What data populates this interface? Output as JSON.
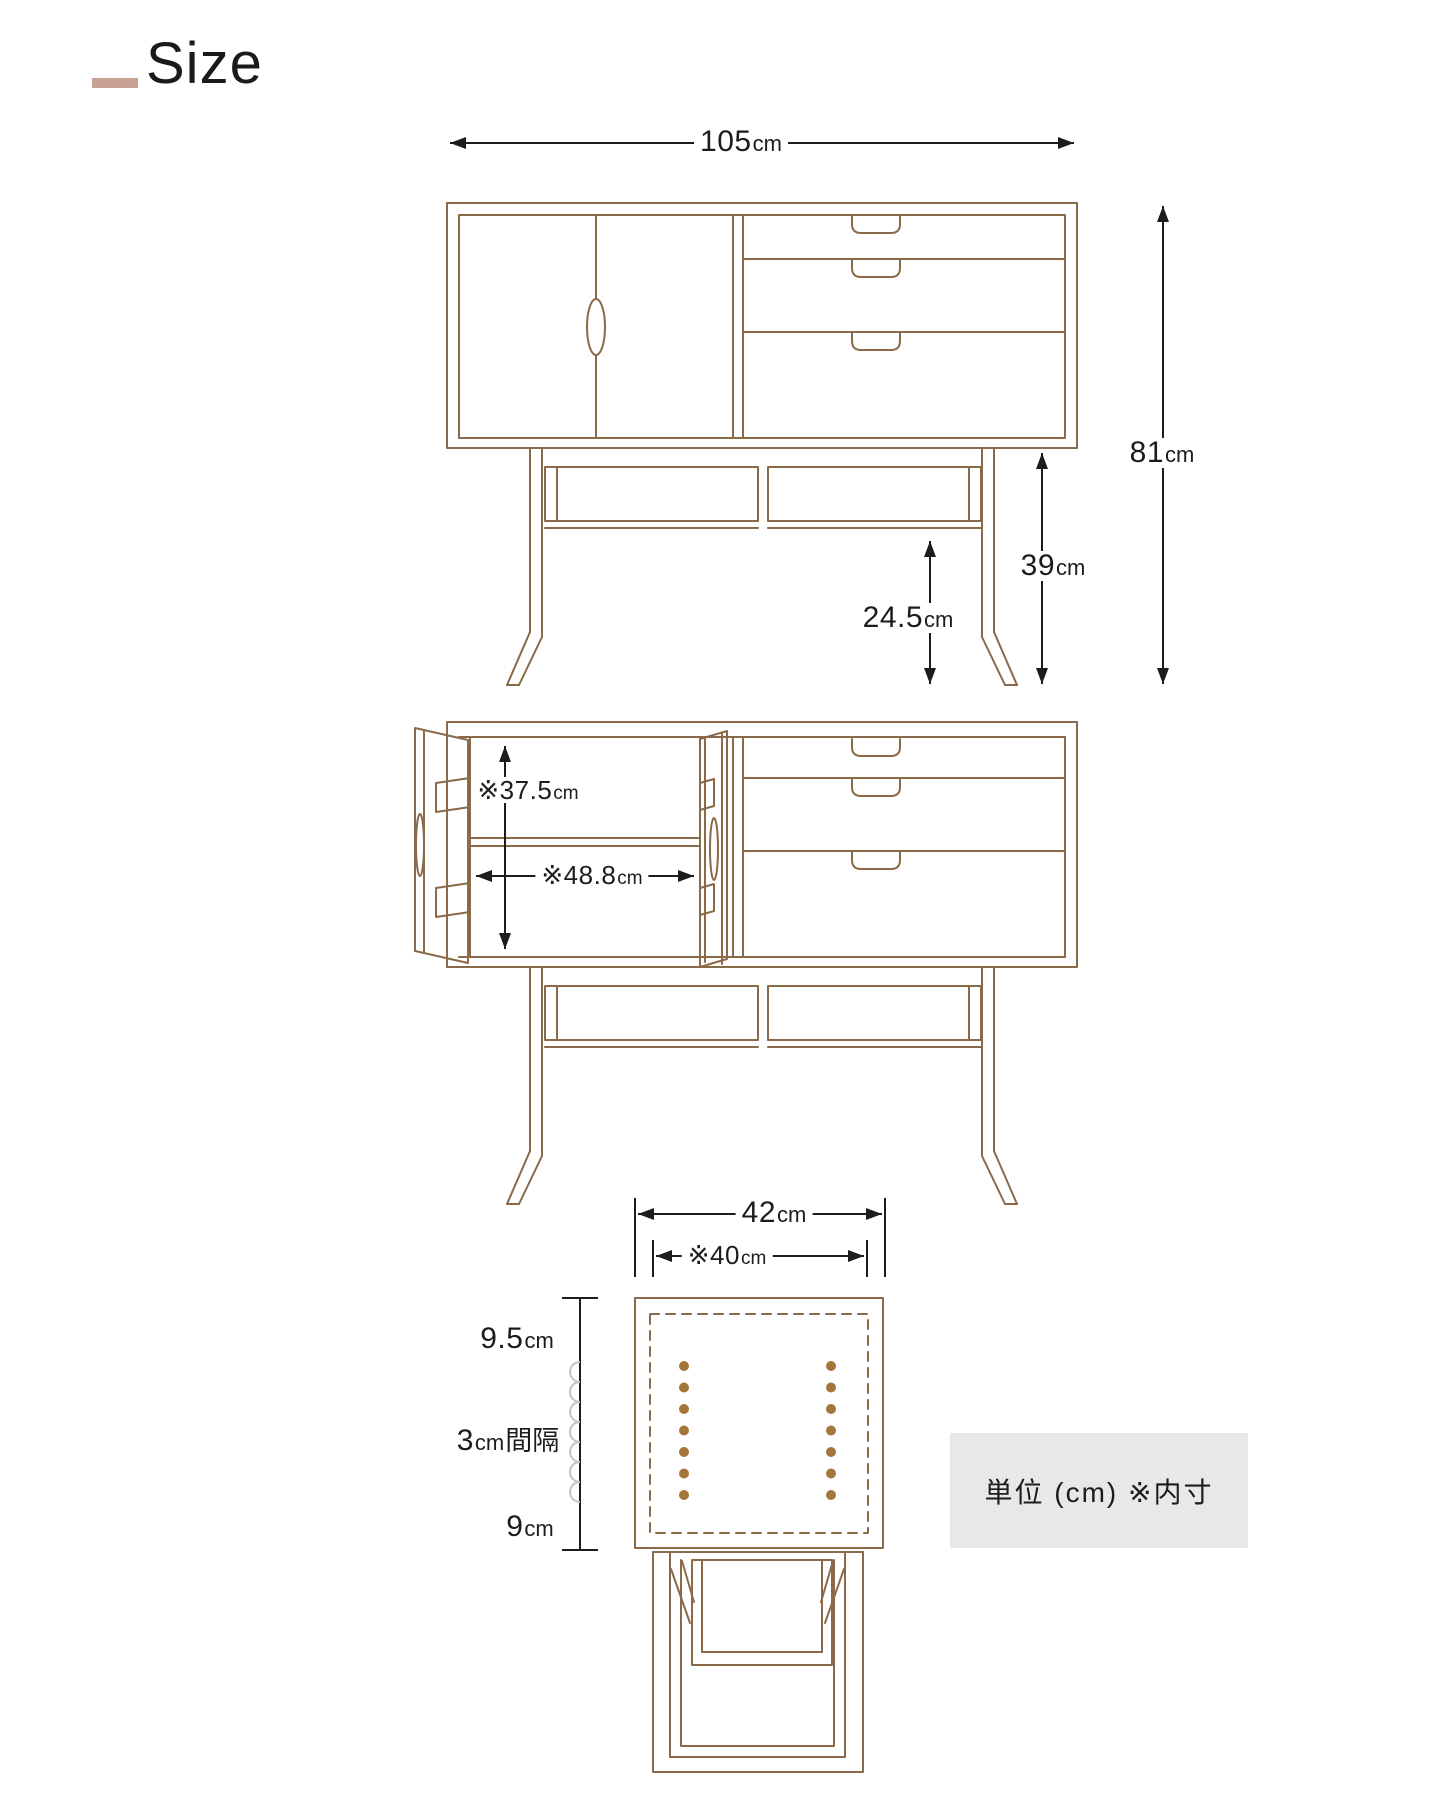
{
  "title": {
    "text": "Size"
  },
  "colors": {
    "line": "#8a6a48",
    "dim": "#1c1c1c",
    "dot": "#a5763c",
    "scallop": "#c9c2b8",
    "accent": "#c7a294",
    "note_bg": "#e8e8e8"
  },
  "note": {
    "text": "単位 (cm) ※内寸"
  },
  "dimensions": {
    "width": {
      "value": "105",
      "unit": "cm"
    },
    "height_total": {
      "value": "81",
      "unit": "cm"
    },
    "stand_height": {
      "value": "39",
      "unit": "cm"
    },
    "shelf_clearance": {
      "value": "24.5",
      "unit": "cm"
    },
    "inner_height": {
      "value": "※37.5",
      "unit": "cm"
    },
    "inner_width": {
      "value": "※48.8",
      "unit": "cm"
    },
    "depth": {
      "value": "42",
      "unit": "cm"
    },
    "inner_depth": {
      "value": "※40",
      "unit": "cm"
    },
    "hole_offset_top": {
      "value": "9.5",
      "unit": "cm"
    },
    "hole_interval": {
      "value": "3",
      "unit": "cm",
      "suffix": "間隔"
    },
    "hole_offset_bottom": {
      "value": "9",
      "unit": "cm"
    }
  }
}
